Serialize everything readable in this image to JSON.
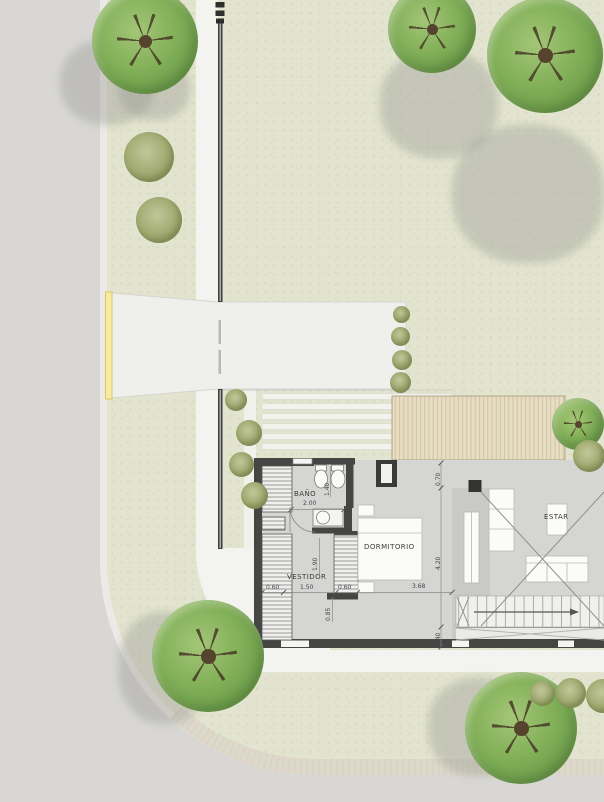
{
  "plan_title": "residential site and floor plan",
  "rooms": [
    {
      "id": "bano",
      "label": "BAÑO",
      "x": 294,
      "y": 490
    },
    {
      "id": "vestidor",
      "label": "VESTIDOR",
      "x": 287,
      "y": 573
    },
    {
      "id": "dormitorio",
      "label": "DORMITORIO",
      "x": 364,
      "y": 543
    },
    {
      "id": "estar",
      "label": "ESTAR",
      "x": 544,
      "y": 513
    }
  ],
  "dimensions": [
    {
      "label": "2.00",
      "x": 303,
      "y": 500,
      "vertical": false
    },
    {
      "label": "1.40",
      "x": 324,
      "y": 496,
      "vertical": true
    },
    {
      "label": "0.70",
      "x": 435,
      "y": 486,
      "vertical": true
    },
    {
      "label": "1.90",
      "x": 312,
      "y": 571,
      "vertical": true
    },
    {
      "label": "4.20",
      "x": 435,
      "y": 570,
      "vertical": true
    },
    {
      "label": "0.60",
      "x": 266,
      "y": 584,
      "vertical": false
    },
    {
      "label": "1.50",
      "x": 300,
      "y": 584,
      "vertical": false
    },
    {
      "label": "0.60",
      "x": 338,
      "y": 584,
      "vertical": false
    },
    {
      "label": "3.68",
      "x": 412,
      "y": 583,
      "vertical": false
    },
    {
      "label": "0.85",
      "x": 325,
      "y": 621,
      "vertical": true
    },
    {
      "label": "0.40",
      "x": 435,
      "y": 646,
      "vertical": true
    }
  ],
  "colors": {
    "lawn": "#e2e4cf",
    "road": "#d8d7d4",
    "sidewalk": "#f3f3ef",
    "driveway": "#efefec",
    "curb_yellow": "#f6eda2",
    "deck_light": "#e7ddc2",
    "deck_dark": "#cab28a",
    "wall_dark": "#454543",
    "tree_green": "#84b15a",
    "tree_olive": "#a3ad74"
  }
}
